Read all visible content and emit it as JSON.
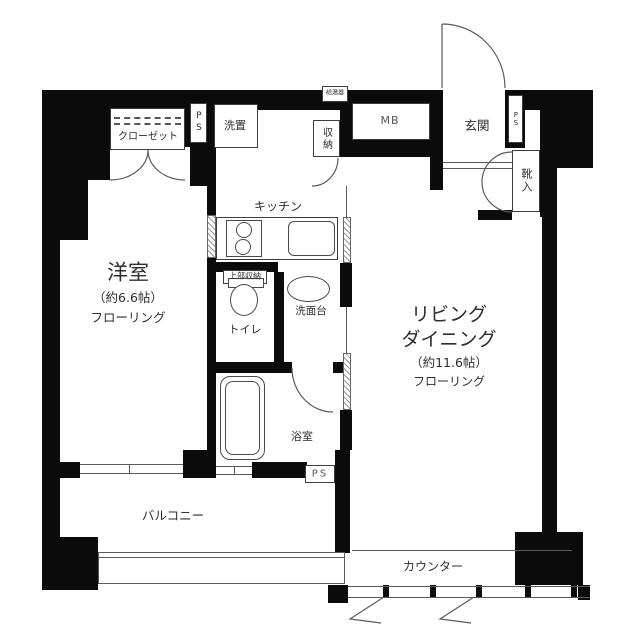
{
  "floorplan": {
    "rooms": {
      "bedroom": {
        "name": "洋室",
        "size": "（約6.6帖）",
        "floor": "フローリング"
      },
      "living": {
        "name1": "リビング",
        "name2": "ダイニング",
        "size": "（約11.6帖）",
        "floor": "フローリング"
      },
      "kitchen": {
        "label": "キッチン"
      },
      "bath": {
        "label": "浴室"
      },
      "toilet": {
        "label": "トイレ"
      },
      "washstand": {
        "label": "洗面台"
      },
      "balcony": {
        "label": "バルコニー"
      },
      "counter": {
        "label": "カウンター"
      },
      "entrance": {
        "label": "玄関"
      }
    },
    "storage": {
      "closet": "クローゼット",
      "shoe_box": "靴入",
      "hall_storage": "収納",
      "upper_storage": "上部収納",
      "laundry": "洗置"
    },
    "utility": {
      "mb": "MB",
      "ps": "PS",
      "water_heater": "給湯器"
    }
  }
}
